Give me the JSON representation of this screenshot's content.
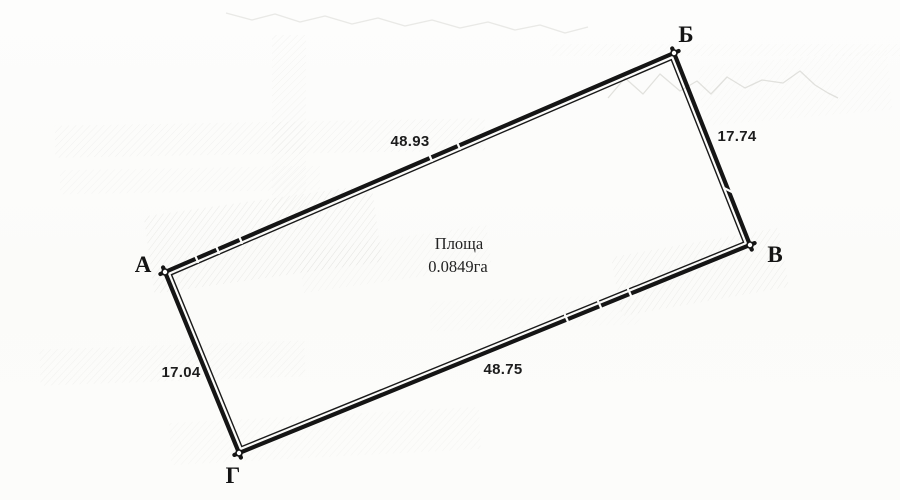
{
  "parcel": {
    "area": {
      "label": "Площа",
      "value": "0.0849га"
    },
    "vertices": [
      {
        "id": "A",
        "label": "А"
      },
      {
        "id": "B",
        "label": "Б"
      },
      {
        "id": "V",
        "label": "В"
      },
      {
        "id": "G",
        "label": "Г"
      }
    ],
    "sides": [
      {
        "edge": "А–Б",
        "position": "top",
        "length": "48.93"
      },
      {
        "edge": "Б–В",
        "position": "right",
        "length": "17.74"
      },
      {
        "edge": "Г–В",
        "position": "bottom",
        "length": "48.75"
      },
      {
        "edge": "А–Г",
        "position": "left",
        "length": "17.04"
      }
    ],
    "colors": {
      "ink": "#151515",
      "paper": "#fbfbf9",
      "scan_noise": "#a9a9a1"
    }
  }
}
